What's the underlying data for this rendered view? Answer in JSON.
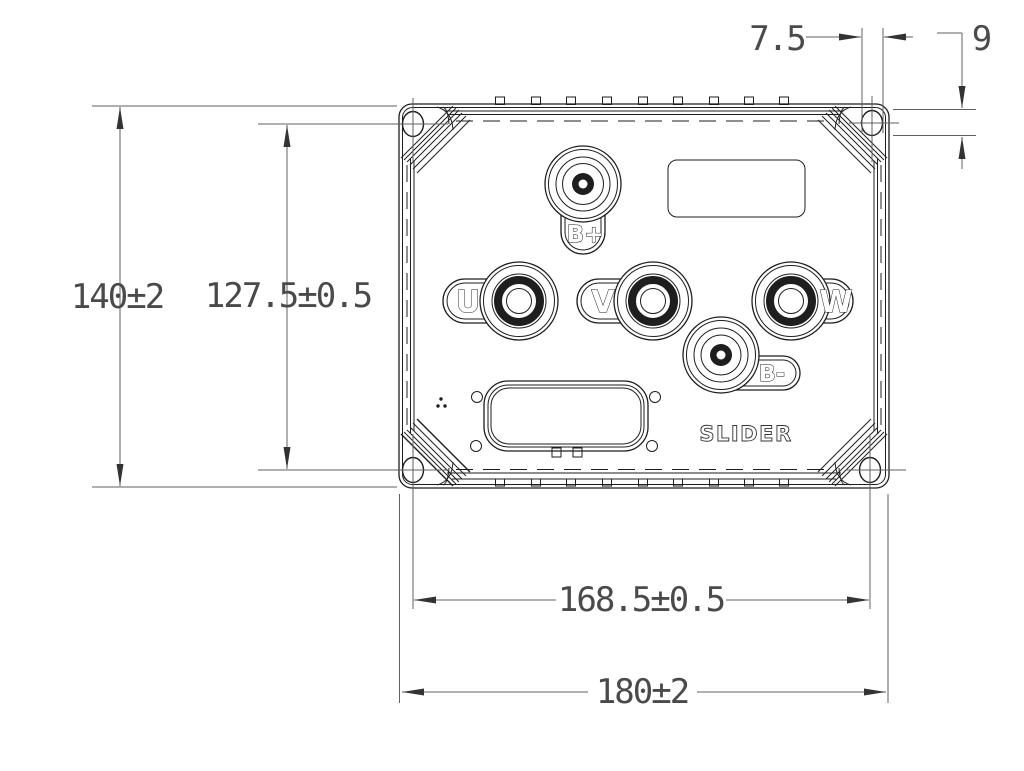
{
  "dimensions": {
    "overall_width": "180±2",
    "bolt_span_width": "168.5±0.5",
    "overall_height": "140±2",
    "bolt_span_height": "127.5±0.5",
    "slot_hole_width": "7.5",
    "slot_hole_height": "9"
  },
  "terminals": {
    "b_plus": "B+",
    "u": "U",
    "v": "V",
    "w": "W",
    "b_minus": "B-"
  },
  "brand_logo": "SLIDER",
  "colors": {
    "line": "#1e1e1e",
    "dim_line": "#606060",
    "dim_text": "#4a4a4a",
    "background": "#ffffff"
  }
}
